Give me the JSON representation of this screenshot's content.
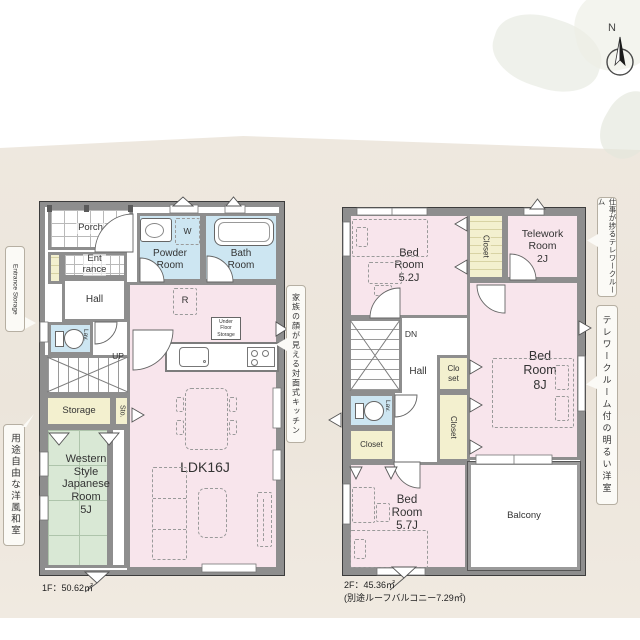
{
  "compass": {
    "label": "N"
  },
  "colors": {
    "wall": "#8e8e8e",
    "room_pink": "#f8e5ec",
    "room_blue": "#cde6f2",
    "room_green": "#d9e8d5",
    "closet_cream": "#f3f0cf",
    "background_beige": "#ece6dc"
  },
  "floor1": {
    "area_label": "1F：50.62㎡",
    "rooms": {
      "porch": "Porch",
      "entrance_lines": [
        "Ent",
        "rance"
      ],
      "hall": "Hall",
      "lav": "Lav.",
      "up": "UP",
      "storage": "Storage",
      "sto": "Sto.",
      "western_lines": [
        "Western",
        "Style",
        "Japanese",
        "Room",
        "5J"
      ],
      "powder_lines": [
        "Powder",
        "Room"
      ],
      "bath_lines": [
        "Bath",
        "Room"
      ],
      "ldk": "LDK16J",
      "washer": "W",
      "fridge": "R",
      "under_floor_lines": [
        "Under",
        "Floor",
        "Storage"
      ]
    },
    "notes": {
      "entrance_storage": "Entrance Storage",
      "kitchen": "家族の顔が見える対面式キッチン",
      "western_room": "用途自由な洋風和室"
    }
  },
  "floor2": {
    "area_label": "2F：45.36㎡",
    "area_sub_label": "(別途ルーフバルコニー7.29㎡)",
    "rooms": {
      "bed52_lines": [
        "Bed",
        "Room",
        "5.2J"
      ],
      "closet_top": "Closet",
      "telework_lines": [
        "Telework",
        "Room",
        "2J"
      ],
      "bed8_lines": [
        "Bed",
        "Room",
        "8J"
      ],
      "dn": "DN",
      "hall": "Hall",
      "closet_small_lines": [
        "Clo",
        "set"
      ],
      "closet_mid": "Closet",
      "lav": "Lav.",
      "closet_low": "Closet",
      "bed57_lines": [
        "Bed",
        "Room",
        "5.7J"
      ],
      "balcony": "Balcony"
    },
    "notes": {
      "telework": "仕事が捗るテレワークルーム",
      "bedroom": "テレワークルーム付の明るい洋室"
    }
  }
}
